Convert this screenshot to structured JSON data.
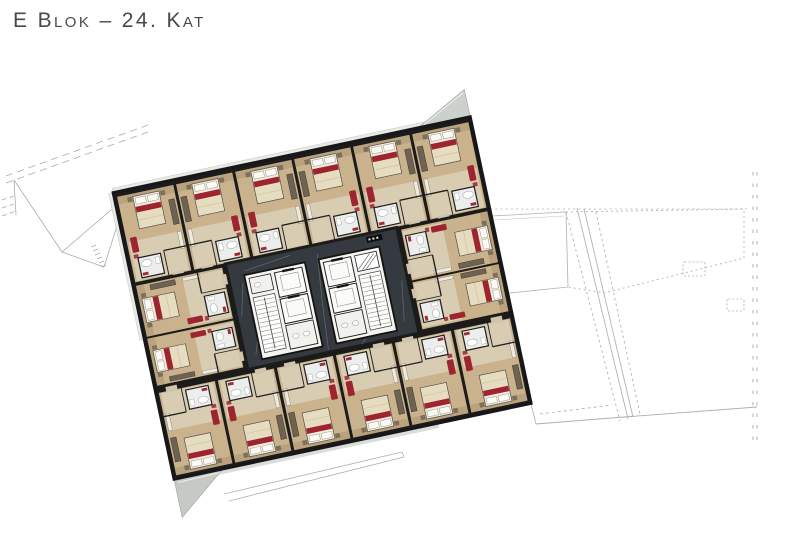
{
  "page": {
    "title": "E Blok – 24. Kat"
  },
  "plan": {
    "colors": {
      "wall": "#1b1b1b",
      "corridor_floor": "#343a40",
      "wood_floor": "#c9b28c",
      "wood_floor_light": "#d9cfb7",
      "bathroom_floor": "#eceeed",
      "core_white": "#f4f4f2",
      "mattress": "#f1ecdd",
      "duvet": "#e6dcc0",
      "accent_red": "#9e2430",
      "terrace_gray": "#c9ccc7",
      "outline_gray": "#a9aca8",
      "title_text": "#46494d"
    }
  }
}
